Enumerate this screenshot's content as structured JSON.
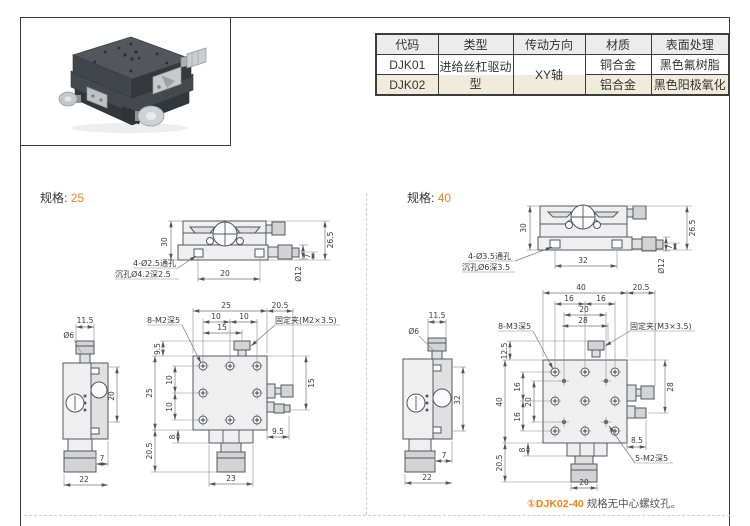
{
  "colors": {
    "accent": "#f08318",
    "row_highlight_bg": "#f1ecd9",
    "table_header_bg": "#ececec",
    "frame_line": "#3c3c3c"
  },
  "table": {
    "headers": [
      "代码",
      "类型",
      "传动方向",
      "材质",
      "表面处理"
    ],
    "rows": [
      {
        "code": "DJK01",
        "type": "进给丝杠驱动型",
        "direction": "XY轴",
        "material": "铜合金",
        "finish": "黑色氟树脂"
      },
      {
        "code": "DJK02",
        "material": "铝合金",
        "finish": "黑色阳极氧化"
      }
    ]
  },
  "spec25": {
    "title": "规格:",
    "size": "25",
    "front": {
      "h_total": "30",
      "w_holes": "20",
      "h_right": "26.5",
      "h_base": "7",
      "knob_dia": "Ø12",
      "note1": "4-Ø2.5通孔",
      "note2": "沉孔Ø4.2深2.5"
    },
    "side": {
      "w_knob": "11.5",
      "shaft_dia": "Ø6",
      "h_travel": "20",
      "w_offset": "7",
      "w_total": "22"
    },
    "plan": {
      "w_top": "25",
      "w_half1": "10",
      "w_half2": "10",
      "w_clamp": "15",
      "w_right": "20.5",
      "thread_label": "8-M2深5",
      "clamp_label": "固定夹(M2×3.5)",
      "h_clamp": "9.5",
      "h_left": "25",
      "h_half1": "10",
      "h_half2": "10",
      "h_knob": "20.5",
      "h_block": "8",
      "r_dim": "15",
      "b_offset": "9.5",
      "b_width": "23"
    }
  },
  "spec40": {
    "title": "规格:",
    "size": "40",
    "front": {
      "h_total": "30",
      "w_holes": "32",
      "h_right": "26.5",
      "h_base": "7",
      "knob_dia": "Ø12",
      "note1": "4-Ø3.5通孔",
      "note2": "沉孔Ø6深3.5"
    },
    "side": {
      "w_knob": "11.5",
      "shaft_dia": "Ø6",
      "h_travel": "32",
      "w_offset": "7",
      "w_total": "22"
    },
    "plan": {
      "w_top": "40",
      "w_half1": "16",
      "w_half2": "16",
      "w_inner": "20",
      "w_clamp": "28",
      "w_right": "20.5",
      "thread_label": "8-M3深5",
      "clamp_label": "固定夹(M3×3.5)",
      "center_label": "5-M2深5",
      "h_clamp": "12.5",
      "h_left": "40",
      "h_half1": "16",
      "h_inner": "20",
      "h_half2": "16",
      "h_knob": "20.5",
      "h_block": "8",
      "r_dim": "28",
      "r_offset": "8.5",
      "b_width": "20"
    }
  },
  "footnote": {
    "marker": "①",
    "code": "DJK02-40",
    "text": "规格无中心螺纹孔。"
  }
}
